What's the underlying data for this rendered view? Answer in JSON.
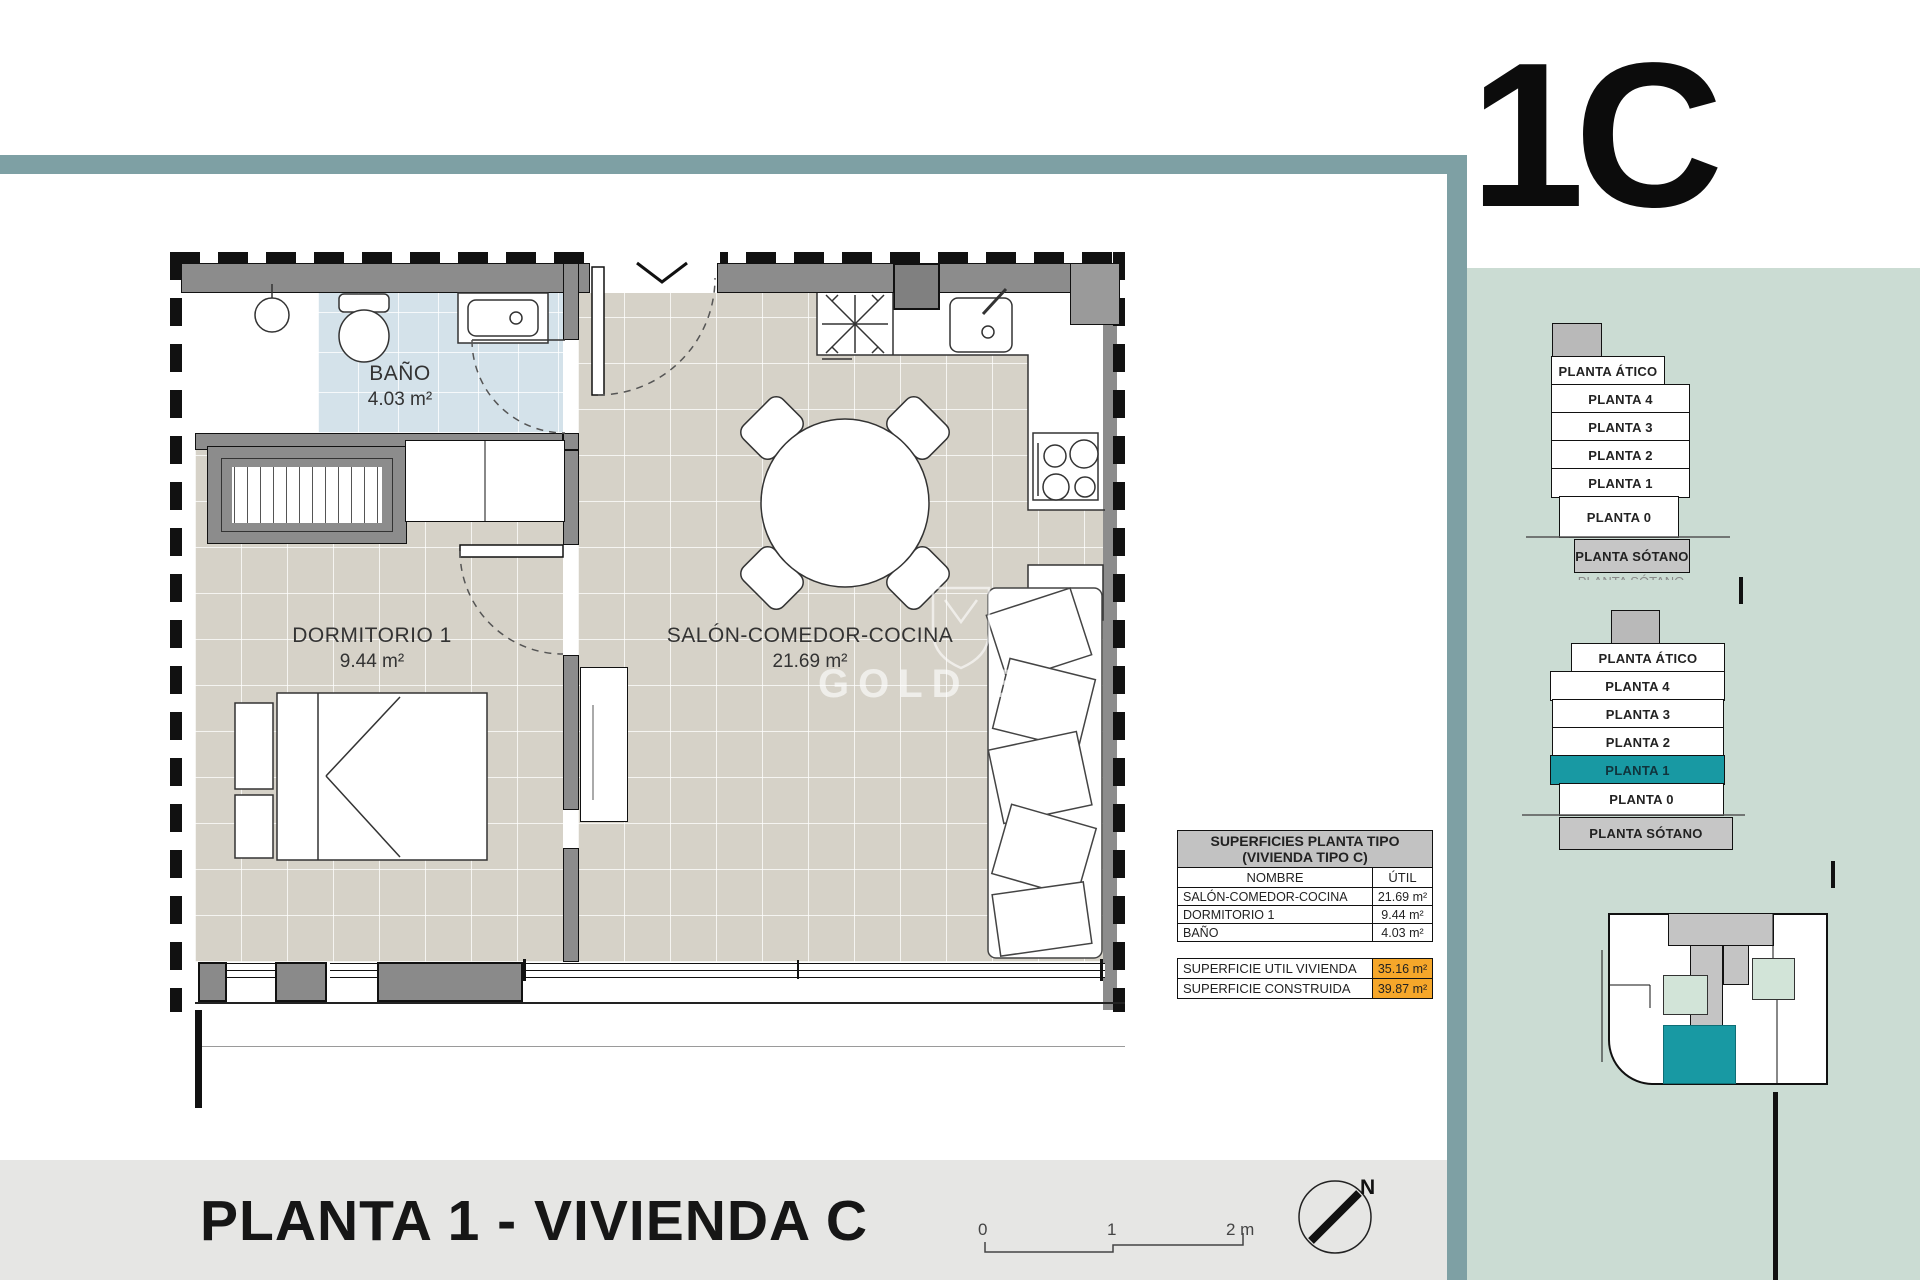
{
  "page": {
    "unit_label": "1C",
    "title": "PLANTA 1 - VIVIENDA C"
  },
  "watermark": {
    "text": "GOLD BR"
  },
  "plan": {
    "rooms": [
      {
        "name": "BAÑO",
        "area": "4.03 m²"
      },
      {
        "name": "DORMITORIO 1",
        "area": "9.44 m²"
      },
      {
        "name": "SALÓN-COMEDOR-COCINA",
        "area": "21.69 m²"
      }
    ]
  },
  "surfaces_table": {
    "title_line1": "SUPERFICIES PLANTA TIPO",
    "title_line2": "(VIVIENDA TIPO C)",
    "col_name": "NOMBRE",
    "col_util": "ÚTIL",
    "rows": [
      {
        "name": "SALÓN-COMEDOR-COCINA",
        "util": "21.69 m²"
      },
      {
        "name": "DORMITORIO 1",
        "util": "9.44 m²"
      },
      {
        "name": "BAÑO",
        "util": "4.03 m²"
      }
    ],
    "totals": [
      {
        "name": "SUPERFICIE UTIL VIVIENDA",
        "util": "35.16 m²"
      },
      {
        "name": "SUPERFICIE CONSTRUIDA",
        "util": "39.87 m²"
      }
    ]
  },
  "stacks": [
    {
      "levels": [
        "PLANTA ÁTICO",
        "PLANTA 4",
        "PLANTA 3",
        "PLANTA 2",
        "PLANTA 1",
        "PLANTA 0",
        "PLANTA SÓTANO"
      ],
      "highlighted_level": ""
    },
    {
      "levels": [
        "PLANTA ÁTICO",
        "PLANTA 4",
        "PLANTA 3",
        "PLANTA 2",
        "PLANTA 1",
        "PLANTA 0",
        "PLANTA SÓTANO"
      ],
      "highlighted_level": "PLANTA 1"
    }
  ],
  "scale_bar": {
    "labels": [
      "0",
      "1",
      "2 m"
    ]
  },
  "compass": {
    "north_label": "N"
  },
  "colors": {
    "frame_teal": "#7EA0A4",
    "panel_sage": "#CBDCD3",
    "highlight_teal": "#1899A3",
    "highlight_orange": "#F6A72A",
    "bath_blue": "#D4E2EA",
    "floor_beige": "#D6D2C8",
    "wall_gray": "#8C8C8C"
  }
}
